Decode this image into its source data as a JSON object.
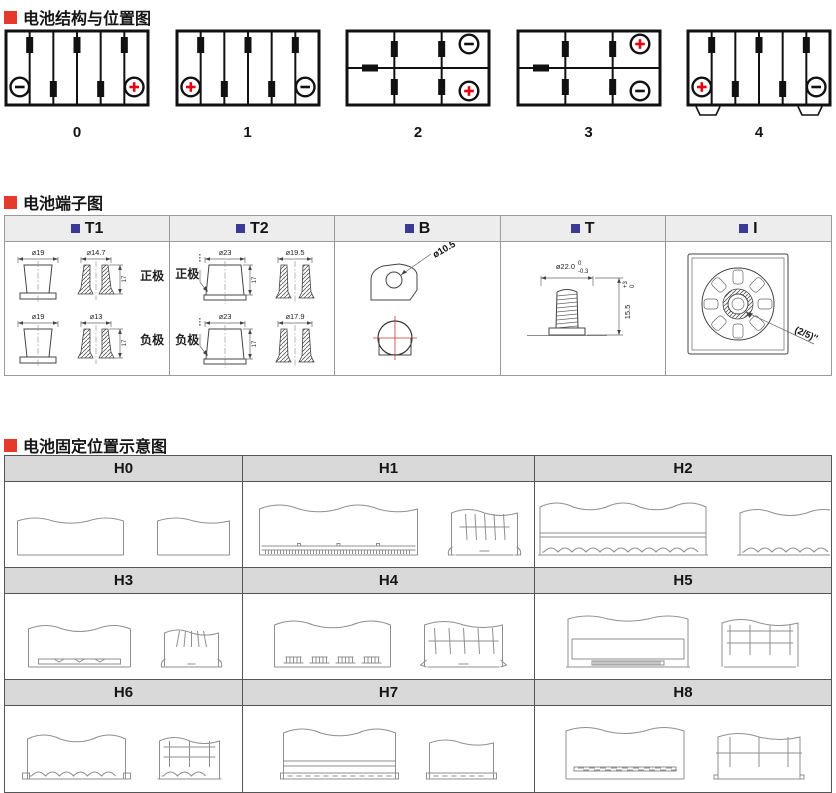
{
  "colors": {
    "accent_red": "#e5392b",
    "accent_blue": "#3a3a94",
    "terminal_plus_red": "#e60012",
    "diagram_black": "#111111",
    "sketch_gray": "#8f8f8f",
    "terminal_table_header_bg": "#ededed",
    "holddown_table_header_bg": "#d9d9d9"
  },
  "sections": {
    "structure": {
      "title": "电池结构与位置图",
      "diagrams": [
        {
          "label": "0",
          "layout": "6-cells-vertical",
          "negative": "bottom-left",
          "positive": "bottom-right",
          "feet": false
        },
        {
          "label": "1",
          "layout": "6-cells-vertical",
          "positive": "bottom-left",
          "negative": "bottom-right",
          "feet": false
        },
        {
          "label": "2",
          "layout": "2x3-grid",
          "negative": "top-right",
          "positive": "bottom-right",
          "feet": false
        },
        {
          "label": "3",
          "layout": "2x3-grid",
          "positive": "top-right",
          "negative": "bottom-right",
          "feet": false
        },
        {
          "label": "4",
          "layout": "6-cells-vertical",
          "positive": "bottom-left",
          "negative": "bottom-right",
          "feet": true
        }
      ]
    },
    "terminals": {
      "title": "电池端子图",
      "columns": [
        "T1",
        "T2",
        "B",
        "T",
        "I"
      ],
      "t1": {
        "pos_label": "正极",
        "neg_label": "负极",
        "pos_outer": "⌀19",
        "pos_inner": "⌀14.7",
        "neg_outer": "⌀19",
        "neg_inner": "⌀13",
        "height": "17"
      },
      "t2": {
        "pos_label": "正极",
        "neg_label": "负极",
        "pos_outer": "⌀23",
        "pos_inner": "⌀19.5",
        "neg_outer": "⌀23",
        "neg_inner": "⌀17.9",
        "height": "17"
      },
      "b": {
        "diameter": "ø10.5"
      },
      "t": {
        "diameter": "ø22.0",
        "dia_tol_upper": "0",
        "dia_tol_lower": "-0.3",
        "height": "15.5",
        "h_tol_upper": "+3",
        "h_tol_lower": "0"
      },
      "i": {
        "thread": "(2/5)″"
      }
    },
    "holddown": {
      "title": "电池固定位置示意图",
      "cells": [
        "H0",
        "H1",
        "H2",
        "H3",
        "H4",
        "H5",
        "H6",
        "H7",
        "H8"
      ]
    }
  }
}
